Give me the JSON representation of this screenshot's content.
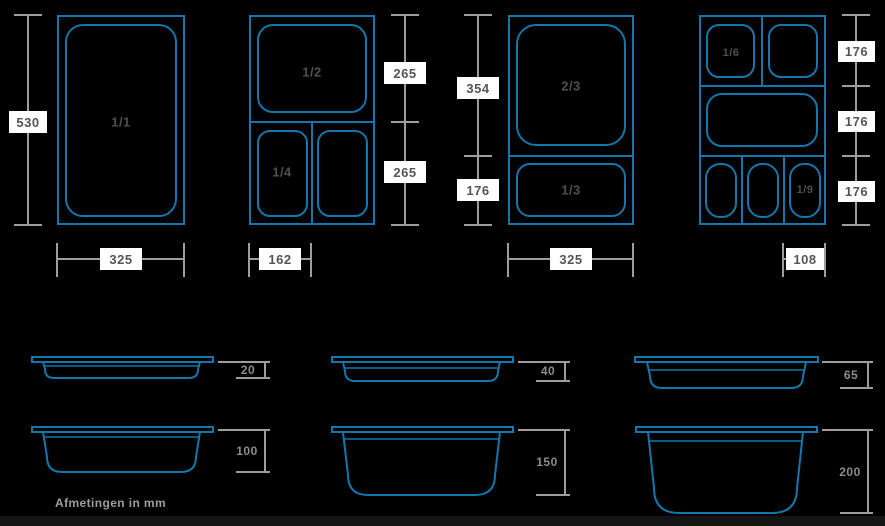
{
  "colors": {
    "background": "#000000",
    "line_blue": "#1476aa",
    "dimension_gray": "#9d9d9d",
    "label_box_bg": "#ffffff",
    "label_box_text": "#555555",
    "pan_label_gray": "#4f4f4f",
    "depth_label_gray": "#8c8c8c",
    "footer_bar": "#141414"
  },
  "top_views": {
    "group1": {
      "pan_label": "1/1",
      "height_dim": "530",
      "width_dim": "325"
    },
    "group2": {
      "half_label": "1/2",
      "quarter_label": "1/4",
      "upper_dim": "265",
      "lower_dim": "265",
      "width_dim": "162"
    },
    "group3": {
      "two_thirds_label": "2/3",
      "one_third_label": "1/3",
      "upper_dim": "354",
      "lower_dim": "176",
      "width_dim": "325"
    },
    "group4": {
      "sixth_label": "1/6",
      "ninth_label": "1/9",
      "row1_dim": "176",
      "row2_dim": "176",
      "row3_dim": "176",
      "width_dim": "108"
    }
  },
  "side_views": {
    "row1": [
      {
        "depth": "20"
      },
      {
        "depth": "40"
      },
      {
        "depth": "65"
      }
    ],
    "row2": [
      {
        "depth": "100"
      },
      {
        "depth": "150"
      },
      {
        "depth": "200"
      }
    ]
  },
  "footer": {
    "note": "Afmetingen in mm"
  }
}
